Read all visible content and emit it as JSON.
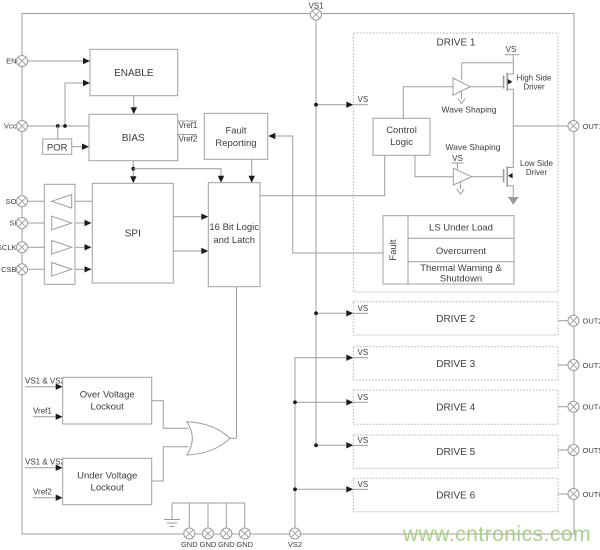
{
  "colors": {
    "wire": "#9c9c9c",
    "arrow": "#1c1c1c",
    "watermark_green": "#a3cc7f"
  },
  "pins": {
    "vs1": "VS1",
    "en": "EN",
    "vcc": "Vcc",
    "so": "SO",
    "si": "SI",
    "sclk": "SCLK",
    "csb": "CSB",
    "vs2": "VS2",
    "gnd": [
      "GND",
      "GND",
      "GND",
      "GND"
    ],
    "outs": [
      "OUT1",
      "OUT2",
      "OUT3",
      "OUT4",
      "OUT5",
      "OUT6"
    ]
  },
  "blocks": {
    "enable": "ENABLE",
    "bias": "BIAS",
    "por": "POR",
    "fault_reporting": [
      "Fault",
      "Reporting"
    ],
    "spi": "SPI",
    "logic": [
      "16 Bit Logic",
      "and Latch"
    ],
    "vref1_out": "Vref1",
    "vref2_out": "Vref2",
    "ovl": [
      "Over Voltage",
      "Lockout"
    ],
    "uvl": [
      "Under Voltage",
      "Lockout"
    ],
    "ovl_in1": "VS1 & VS2",
    "ovl_in2": "Vref1",
    "uvl_in1": "VS1 & VS2",
    "uvl_in2": "Vref2"
  },
  "drive1": {
    "title": "DRIVE 1",
    "vs_in": "VS",
    "vs_top": "VS",
    "vs_low": "VS",
    "control": [
      "Control",
      "Logic"
    ],
    "wave_top": "Wave Shaping",
    "wave_low": "Wave Shaping",
    "high_side": [
      "High Side",
      "Driver"
    ],
    "low_side": [
      "Low Side",
      "Driver"
    ],
    "fault": {
      "label": "Fault",
      "row1": "LS Under Load",
      "row2": "Overcurrent",
      "row3a": "Thermal Warning &",
      "row3b": "Shutdown"
    }
  },
  "drives": [
    {
      "title": "DRIVE 2",
      "vs": "VS"
    },
    {
      "title": "DRIVE 3",
      "vs": "VS"
    },
    {
      "title": "DRIVE 4",
      "vs": "VS"
    },
    {
      "title": "DRIVE 5",
      "vs": "VS"
    },
    {
      "title": "DRIVE 6",
      "vs": "VS"
    }
  ],
  "watermark": {
    "text": "www.cntronics.com"
  }
}
